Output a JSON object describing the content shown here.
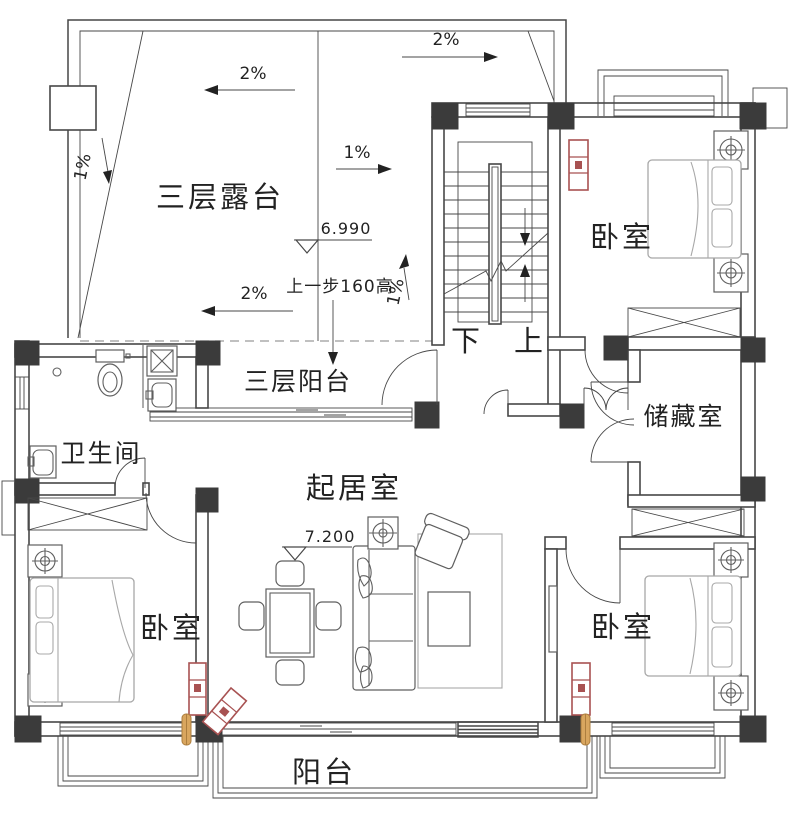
{
  "rooms": {
    "terrace": {
      "label": "三层露台"
    },
    "balcony3": {
      "label": "三层阳台"
    },
    "bathroom": {
      "label": "卫生间"
    },
    "living": {
      "label": "起居室"
    },
    "storage": {
      "label": "储藏室"
    },
    "bedroom_tr": {
      "label": "卧室"
    },
    "bedroom_bl": {
      "label": "卧室"
    },
    "bedroom_br": {
      "label": "卧室"
    },
    "balcony": {
      "label": "阳台"
    }
  },
  "stairs": {
    "down": "下",
    "up": "上"
  },
  "levels": {
    "terrace": "6.990",
    "living": "7.200"
  },
  "notes": {
    "step": "上一步160高"
  },
  "slopes": {
    "top": "2%",
    "mid_left": "2%",
    "bottom": "2%",
    "mid": "1%",
    "left": "1%",
    "stair": "1%"
  },
  "colors": {
    "line": "#474747",
    "furn_dark": "#5f5f5f",
    "furn_light": "#a8a8a8",
    "column": "#3b3b3b",
    "brick": "#a85252",
    "wood": "#d9a65f",
    "dash": "#9b9b9b",
    "text": "#222222",
    "bg": "#ffffff"
  }
}
